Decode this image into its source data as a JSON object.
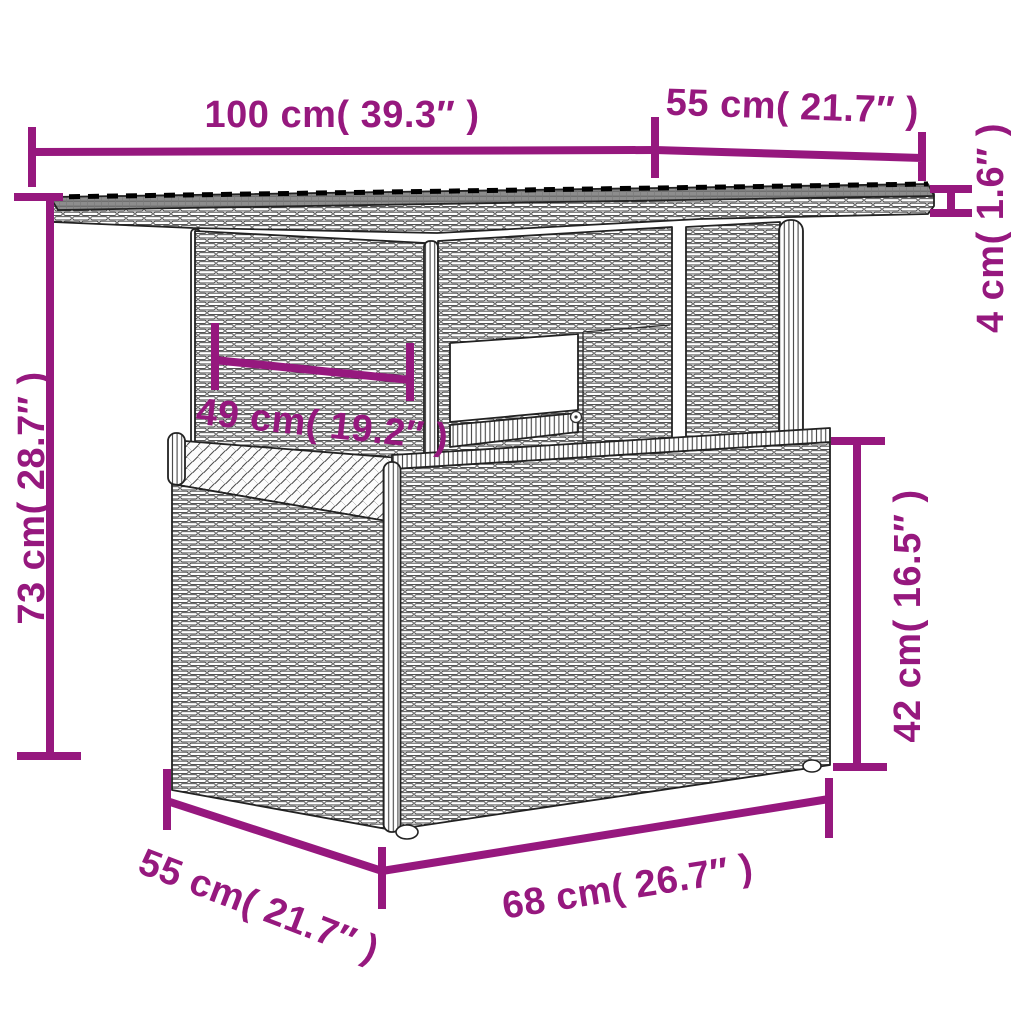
{
  "diagram": {
    "type": "furniture-dimension-diagram",
    "subject": "poly rattan pedestal garden table with glass top",
    "style": {
      "dimension_color": "#96187e",
      "line_art_color": "#222222",
      "glass_top_color": "#8d8d8d",
      "background": "#ffffff"
    },
    "dimensions": {
      "top_width": {
        "label": "100 cm( 39.3″ )"
      },
      "top_depth": {
        "label": "55 cm( 21.7″ )"
      },
      "top_thickness": {
        "label": "4 cm( 1.6″ )"
      },
      "overall_height": {
        "label": "73 cm( 28.7″ )"
      },
      "pedestal_width": {
        "label": "49 cm( 19.2″ )"
      },
      "base_height": {
        "label": "42 cm( 16.5″ )"
      },
      "base_depth": {
        "label": "55 cm( 21.7″ )"
      },
      "base_width": {
        "label": "68 cm( 26.7″ )"
      }
    }
  }
}
